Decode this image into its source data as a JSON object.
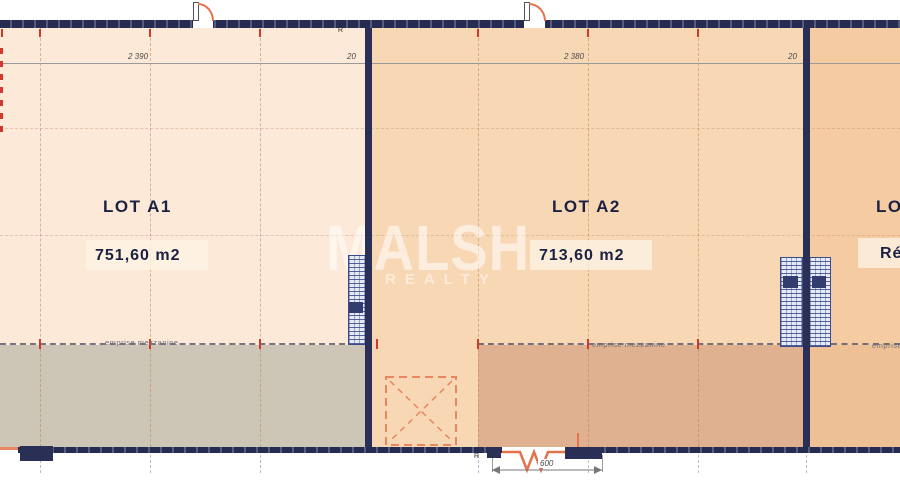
{
  "watermark": {
    "line1": "MALSH",
    "line2": "REALTY"
  },
  "lots": {
    "a1": {
      "name": "LOT A1",
      "area": "751,60 m2",
      "width_dim": "2 390",
      "mezzanine_label": "emprise mezzanine"
    },
    "a2": {
      "name": "LOT A2",
      "area": "713,60 m2",
      "width_dim": "2 380",
      "mezzanine_label": "emprise mezzanine",
      "entrance_dim": "600"
    },
    "a3": {
      "name": "LOT A3",
      "status": "Réservé",
      "mezzanine_label": "emprise mezzanine"
    }
  },
  "dimensions": {
    "wall_thickness": "20"
  },
  "markers": {
    "reference": "R"
  },
  "colors": {
    "wall": "#2a2f55",
    "floor_a1": "#fce9d8",
    "floor_a2": "#f8d7b5",
    "floor_a3": "#f5cba1",
    "mezzanine_a1": "#cdc5b6",
    "mezzanine_a2": "#dfb190",
    "mezzanine_a3": "#eec096",
    "accent_red": "#cf3a2c",
    "door_orange": "#e4724a",
    "label_navy": "#1b2142"
  }
}
